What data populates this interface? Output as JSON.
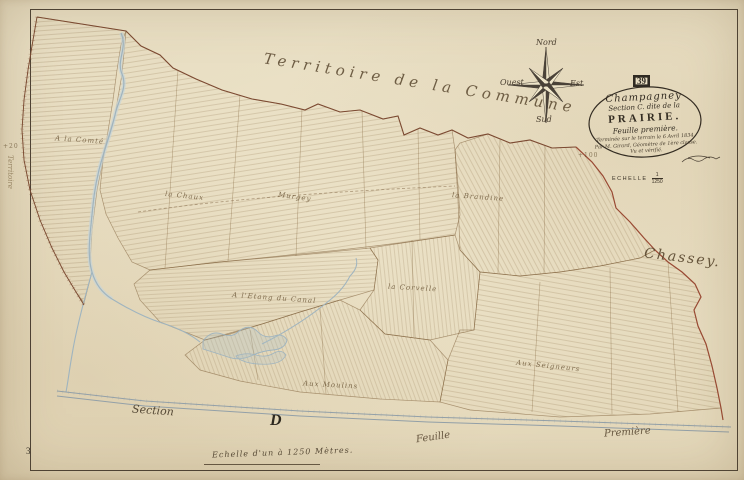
{
  "cartouche": {
    "commune": "Champagney",
    "section_line": "Section C. dite de la",
    "name": "PRAIRIE.",
    "sheet_line": "Feuille première.",
    "note1": "Terminée sur le terrain le 6 Avril 1834.",
    "note2": "Par M. Girard, Géomètre de 1ère classe.",
    "note3": "Vu et vérifié."
  },
  "scale": {
    "label": "ECHELLE",
    "numerator": "1",
    "denominator": "1250",
    "bottom_text": "Echelle d'un à 1250 Mètres."
  },
  "compass": {
    "north": "Nord",
    "east": "Est",
    "south": "Sud",
    "west": "Ouest"
  },
  "margins": {
    "sheet_box": "39",
    "page_number": "3",
    "territory": "Territoire de la Commune",
    "neighbor_right": "Chassey.",
    "section_word": "Section",
    "section_letter": "D",
    "feuille_bottom": "Feuille",
    "premiere_bottom": "Première",
    "plus_right": "+100",
    "plus_left": "+20",
    "left_margin_note": "Territoire"
  },
  "lieux": [
    {
      "text": "A la Comté"
    },
    {
      "text": "la Chaux"
    },
    {
      "text": "Murgey"
    },
    {
      "text": "la Brandine"
    },
    {
      "text": "A l'Etang du Canal"
    },
    {
      "text": "la Corvelle"
    },
    {
      "text": "Aux Moulins"
    },
    {
      "text": "Aux Seigneurs"
    }
  ],
  "colors": {
    "paper": "#e8dec2",
    "ink": "#3a3226",
    "boundary": "#7c4a32",
    "boundary_red": "#9a4a34",
    "parcel_line": "#8a6a45",
    "water": "#9fb4bf",
    "road": "#93a0a8"
  }
}
